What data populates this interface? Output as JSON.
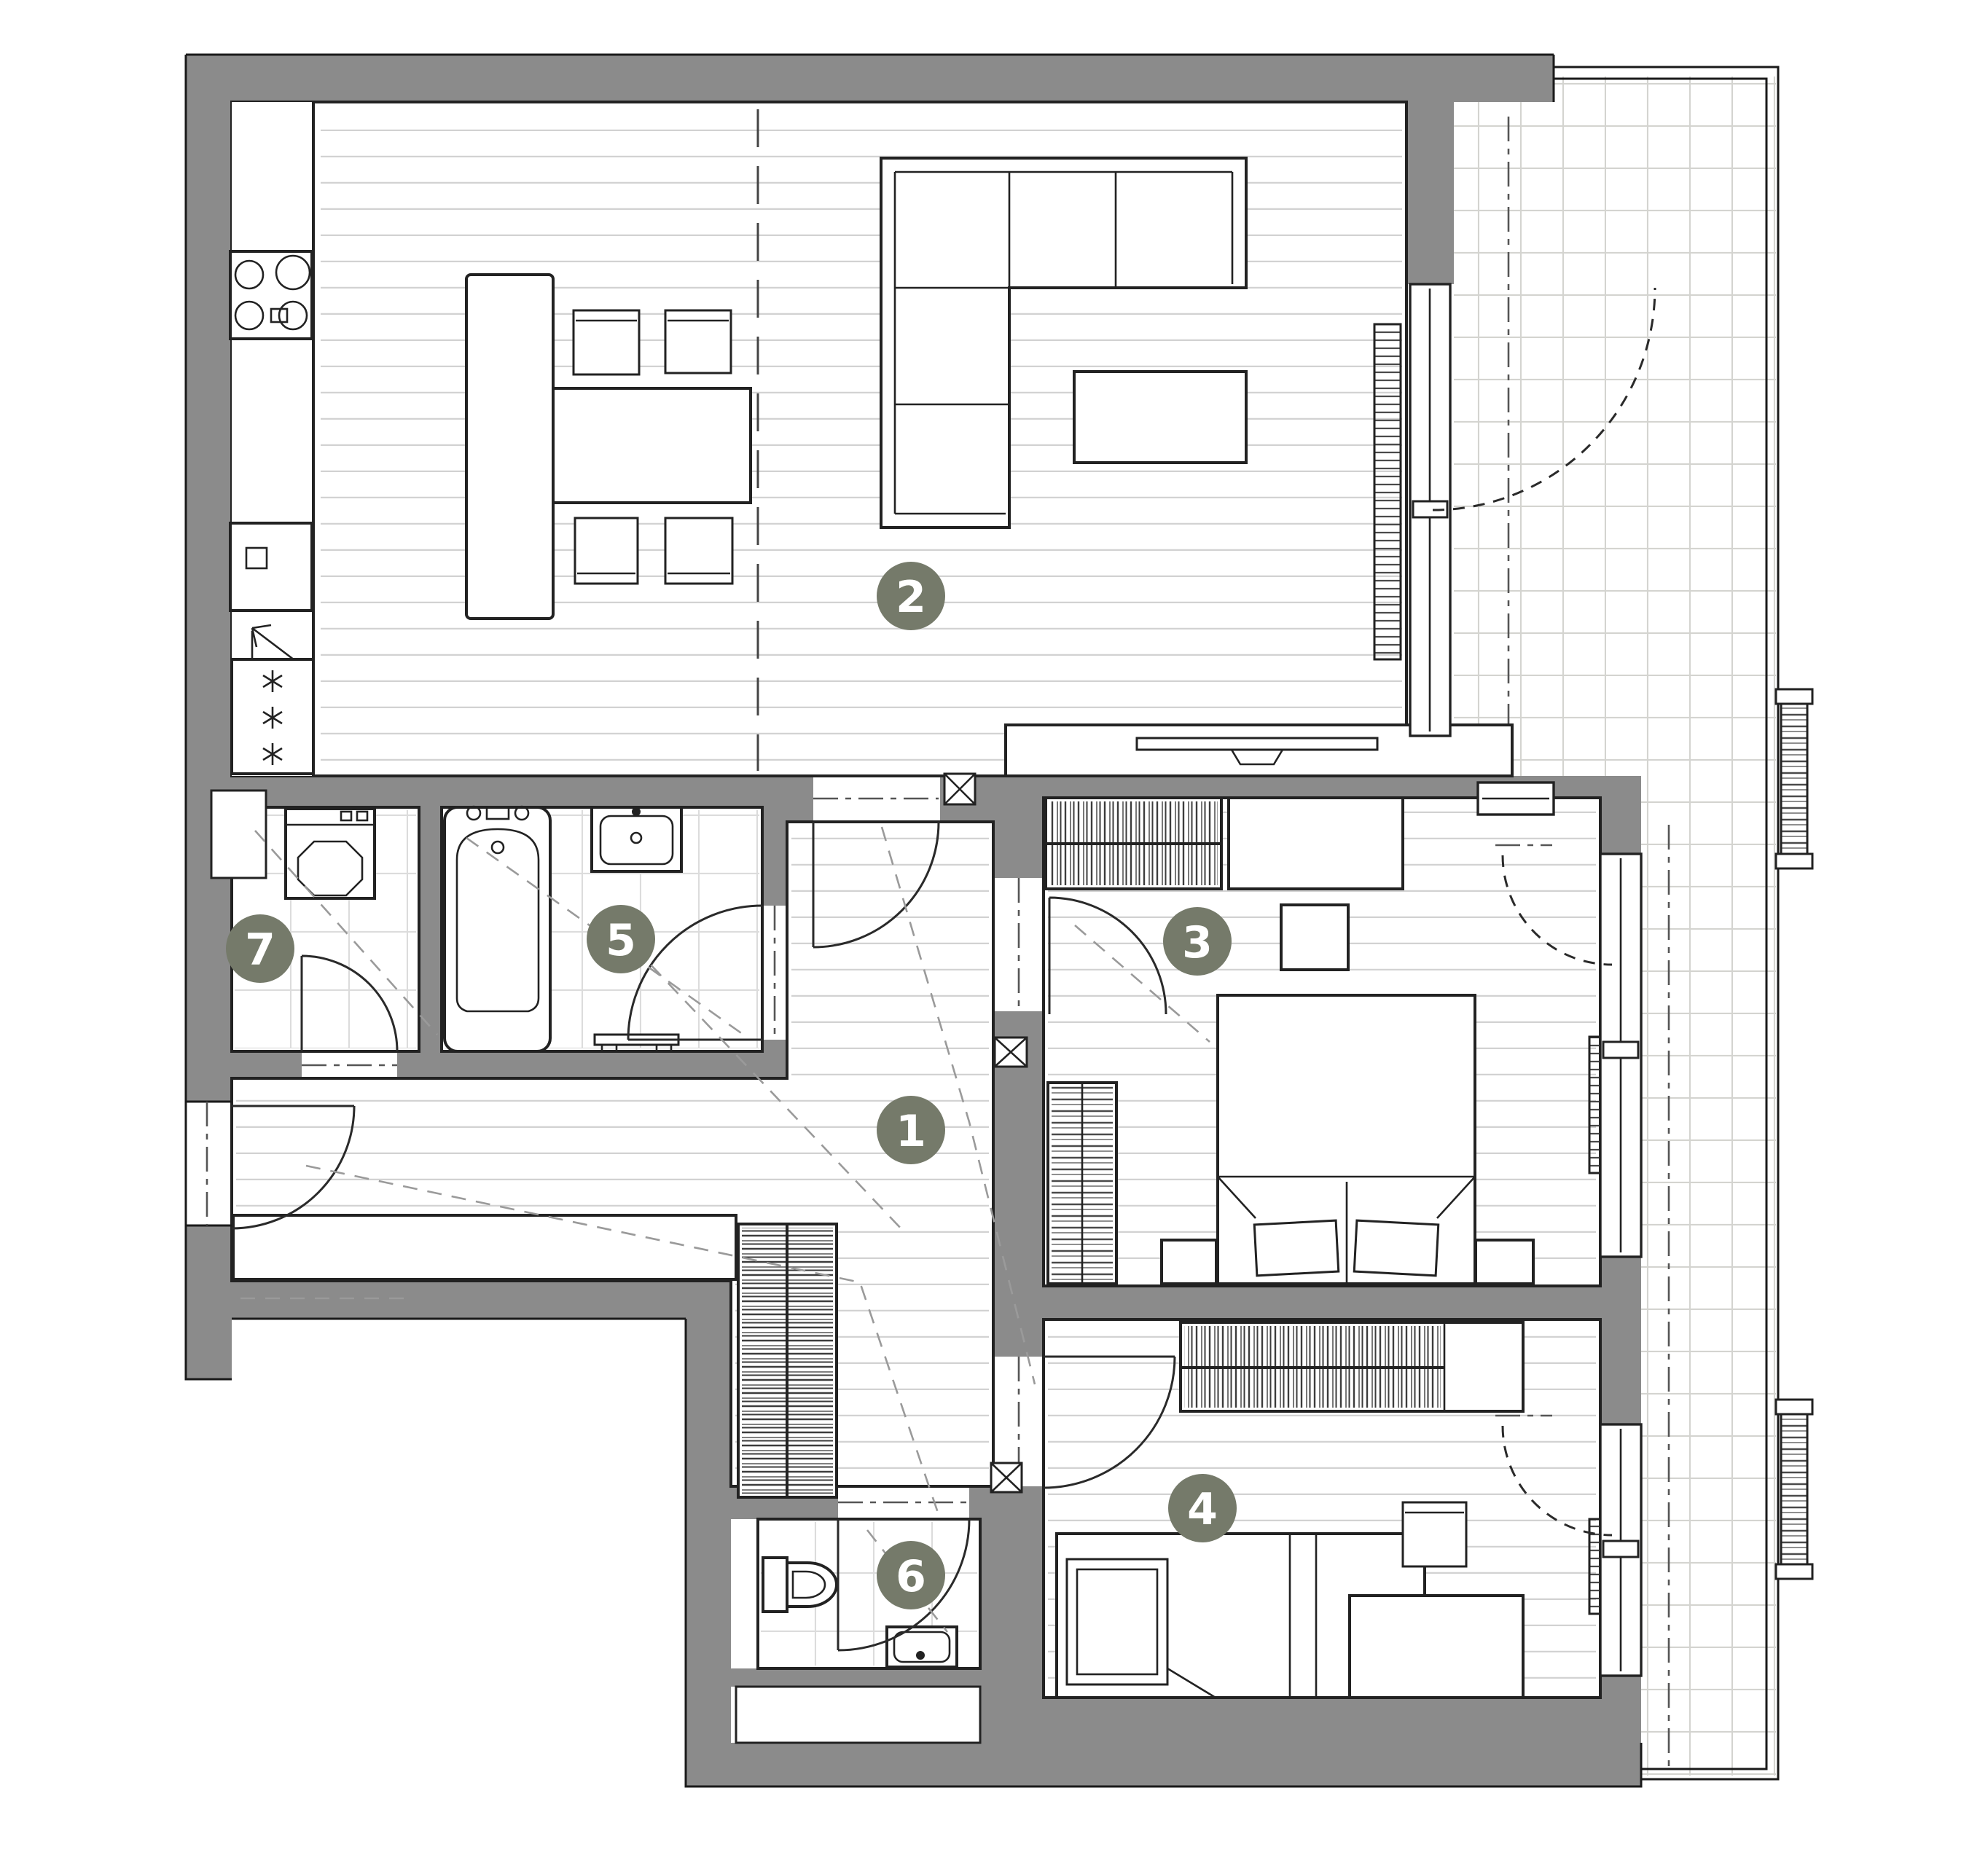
{
  "plan": {
    "type": "apartment-floor-plan",
    "rooms": [
      {
        "number": "1"
      },
      {
        "number": "2"
      },
      {
        "number": "3"
      },
      {
        "number": "4"
      },
      {
        "number": "5"
      },
      {
        "number": "6"
      },
      {
        "number": "7"
      }
    ]
  },
  "colors": {
    "wall": "#8b8b8b",
    "badge": "#757a6a",
    "line": "#222222",
    "plank_line": "#d2d2d2",
    "tile_line": "#dcdcdc",
    "balcony_tile_line": "#d4d4d0"
  }
}
